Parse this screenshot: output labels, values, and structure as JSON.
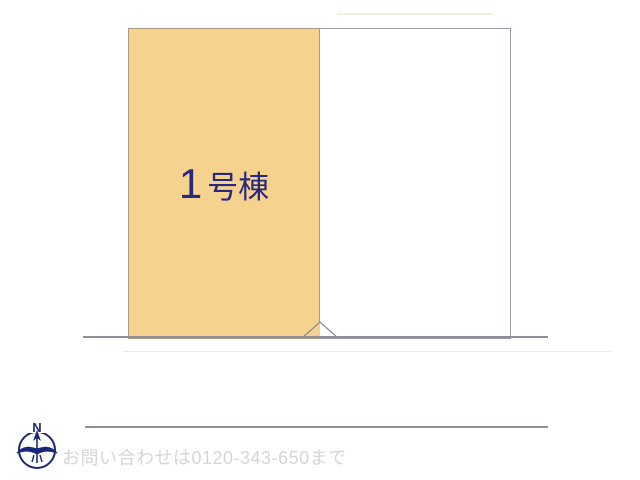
{
  "page": {
    "background_color": "#ffffff",
    "kind": "real-estate site plan"
  },
  "plan": {
    "building_lot": {
      "number": "1",
      "suffix": "号棟",
      "full_label": "1号棟",
      "fill_color": "#f6d28f",
      "label_color": "#28287e"
    },
    "adjacent_lot": {
      "fill_color": "#ffffff",
      "border_color": "#9a9aae"
    },
    "road_line_color": "#8f8f9c",
    "entrance_marker": "triangle"
  },
  "compass": {
    "north_label": "N",
    "color": "#1b2878"
  },
  "footer": {
    "contact_text": "お問い合わせは0120-343-650まで",
    "text_color": "#d6d6d2"
  }
}
